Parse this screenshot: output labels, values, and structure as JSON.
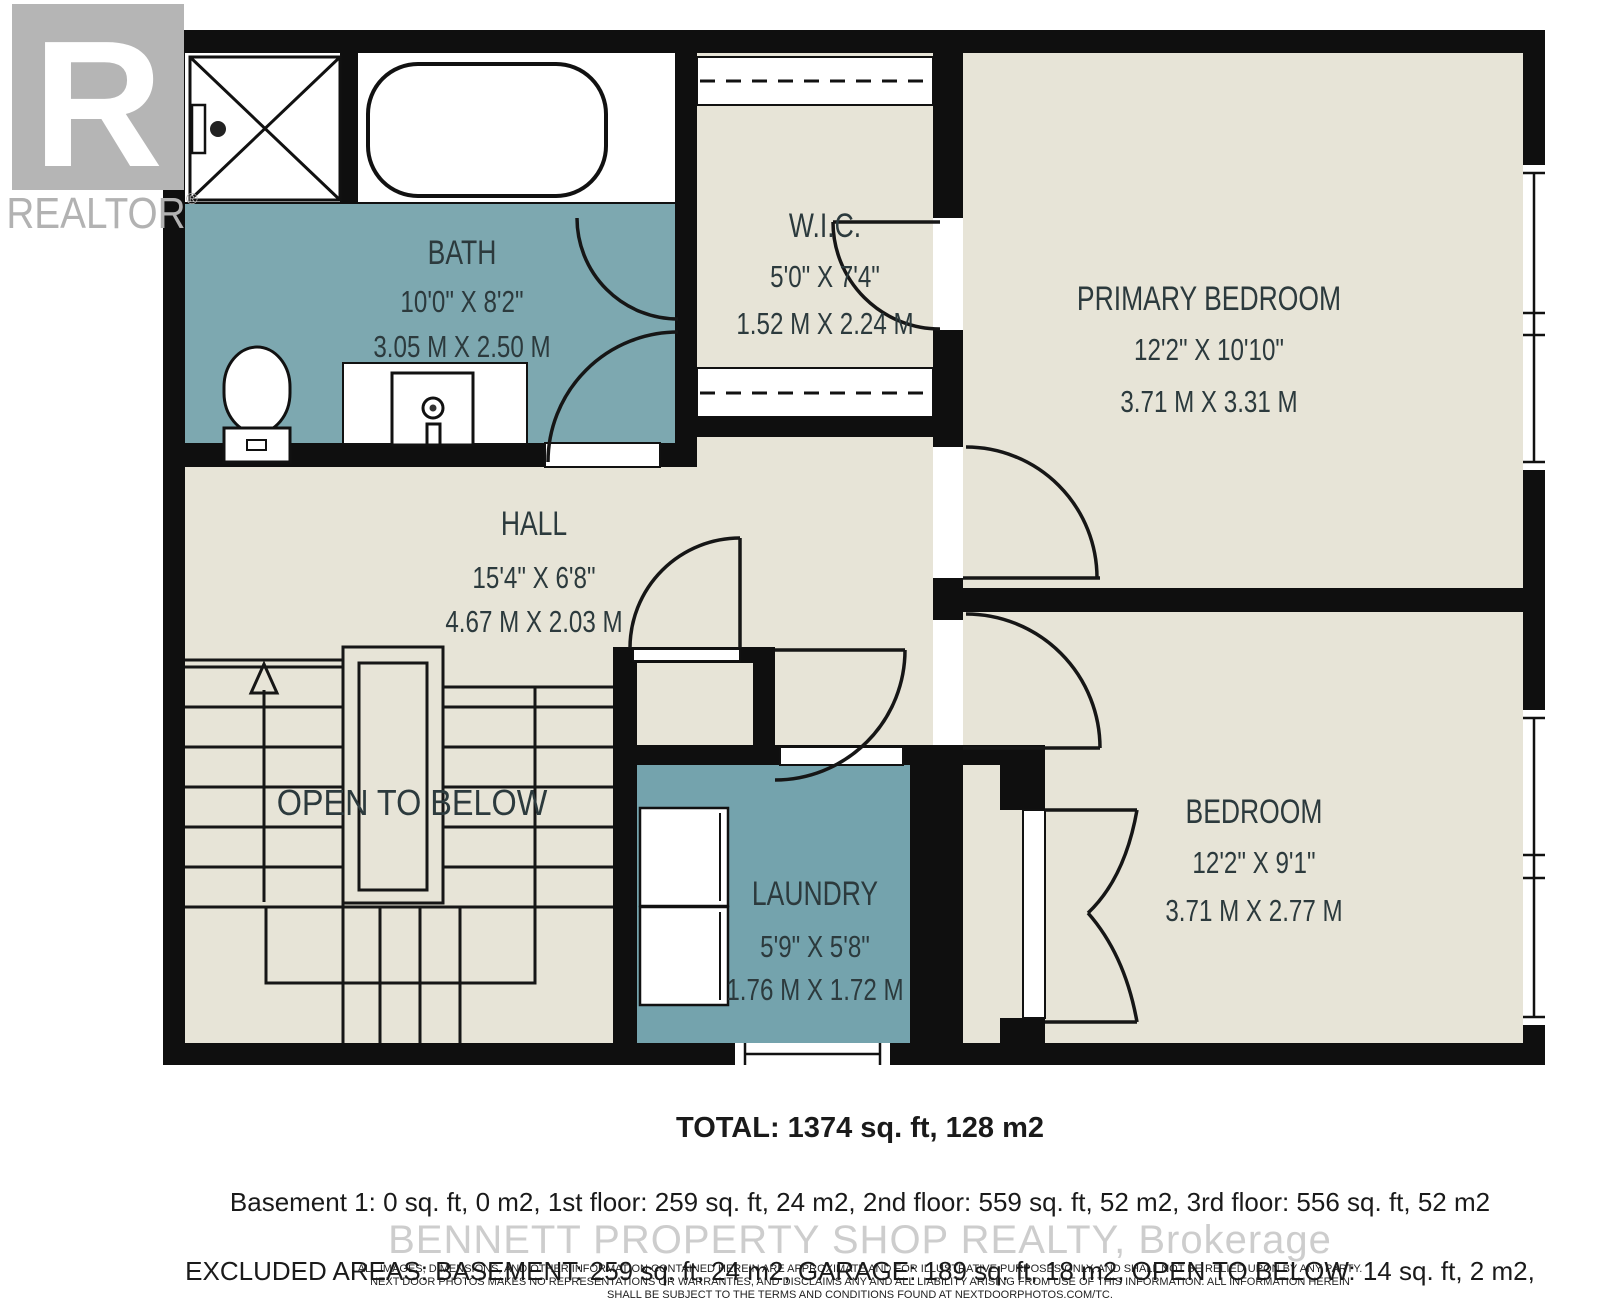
{
  "branding": {
    "logo_letter": "R",
    "logo_text": "REALTOR",
    "registered_mark": "®"
  },
  "rooms": {
    "bath": {
      "name": "BATH",
      "imperial": "10'0\" X 8'2\"",
      "metric": "3.05 M X 2.50 M"
    },
    "wic": {
      "name": "W.I.C.",
      "imperial": "5'0\" X 7'4\"",
      "metric": "1.52 M X 2.24 M"
    },
    "primary_bedroom": {
      "name": "PRIMARY BEDROOM",
      "imperial": "12'2\" X 10'10\"",
      "metric": "3.71 M X 3.31 M"
    },
    "hall": {
      "name": "HALL",
      "imperial": "15'4\" X 6'8\"",
      "metric": "4.67 M X 2.03 M"
    },
    "open_to_below": {
      "name": "OPEN TO BELOW"
    },
    "laundry": {
      "name": "LAUNDRY",
      "imperial": "5'9\" X 5'8\"",
      "metric": "1.76 M X 1.72 M"
    },
    "bedroom": {
      "name": "BEDROOM",
      "imperial": "12'2\" X 9'1\"",
      "metric": "3.71 M X 2.77 M"
    }
  },
  "summary": {
    "total": "TOTAL: 1374 sq. ft, 128 m2",
    "floors": "Basement 1: 0 sq. ft, 0 m2, 1st floor: 259 sq. ft, 24 m2, 2nd floor: 559 sq. ft, 52 m2, 3rd floor: 556 sq. ft, 52 m2",
    "excluded": "EXCLUDED AREAS: BASEMENT: 259 sq. ft, 24 m2, GARAGE: 189 sq. ft, 18 m2, OPEN TO BELOW: 14 sq. ft, 2 m2,",
    "walls": "WALLS: 181 sq. ft, 15 m2"
  },
  "watermark": "BENNETT PROPERTY SHOP REALTY, Brokerage",
  "disclaimer": {
    "line1": "ALL IMAGES, DIMENSIONS, AND OTHER INFORMATION CONTAINED HEREIN ARE APPROXIMATE AND FOR ILLUSTRATIVE PURPOSES ONLY, AND SHALL NOT BE RELIED UPON BY ANY PARTY.",
    "line2": "NEXT DOOR PHOTOS MAKES NO REPRESENTATIONS OR WARRANTIES, AND DISCLAIMS ANY AND ALL LIABILITY ARISING FROM USE OF THIS INFORMATION. ALL INFORMATION HEREIN",
    "line3": "SHALL BE SUBJECT TO THE TERMS AND CONDITIONS FOUND AT NEXTDOORPHOTOS.COM/TC."
  },
  "colors": {
    "wall": "#0f0f0f",
    "floor_beige": "#e7e4d7",
    "bath_teal": "#7da8b0",
    "laundry_teal": "#74a3ad",
    "label": "#2c3a3d",
    "logo_gray": "#b5b5b5",
    "watermark_gray": "#cdcdcd"
  }
}
